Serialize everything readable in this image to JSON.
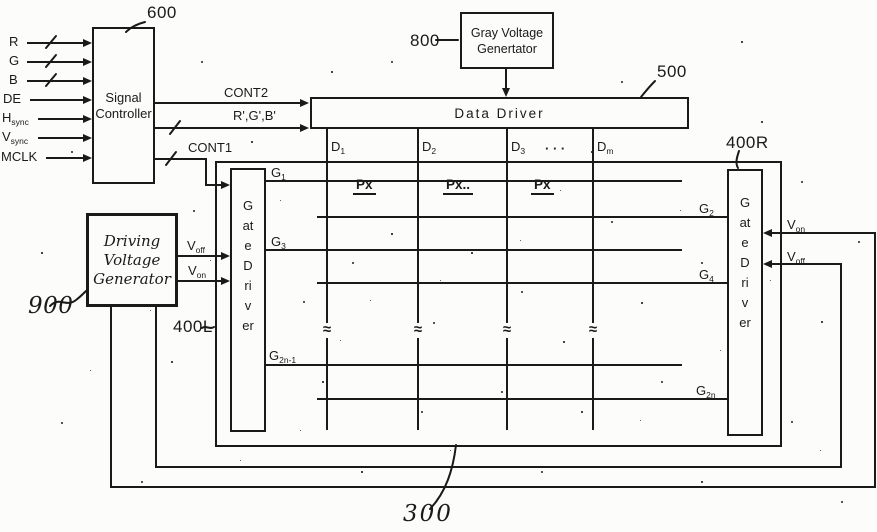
{
  "figure": {
    "refs": {
      "signal_controller": "600",
      "gray_voltage": "800",
      "data_driver": "500",
      "gate_driver_right": "400R",
      "gate_driver_left": "400L",
      "driving_voltage": "900",
      "panel": "300"
    },
    "signal_controller": {
      "line1": "Signal",
      "line2": "Controller"
    },
    "gray_voltage": {
      "line1": "Gray Voltage",
      "line2": "Genertator"
    },
    "data_driver_label": "Data Driver",
    "gate_driver_vertical": "Gate Driver",
    "driving_voltage": {
      "line1": "Driving",
      "line2": "Voltage",
      "line3": "Generator"
    },
    "inputs": [
      {
        "base": "R"
      },
      {
        "base": "G"
      },
      {
        "base": "B"
      },
      {
        "base": "DE"
      },
      {
        "base": "H",
        "sub": "sync"
      },
      {
        "base": "V",
        "sub": "sync"
      },
      {
        "base": "MCLK"
      }
    ],
    "control_signals": {
      "cont2": "CONT2",
      "rgb_prime": "R',G',B'",
      "cont1": "CONT1"
    },
    "gate_lines": [
      {
        "base": "G",
        "sub": "1"
      },
      {
        "base": "G",
        "sub": "2"
      },
      {
        "base": "G",
        "sub": "3"
      },
      {
        "base": "G",
        "sub": "4"
      },
      {
        "base": "G",
        "sub": "2n-1"
      },
      {
        "base": "G",
        "sub": "2n"
      }
    ],
    "data_lines": [
      {
        "base": "D",
        "sub": "1"
      },
      {
        "base": "D",
        "sub": "2"
      },
      {
        "base": "D",
        "sub": "3"
      },
      {
        "base": "D",
        "sub": "m"
      }
    ],
    "ellipsis": "· · ·",
    "pixels": [
      {
        "label": "Px",
        "trail": ""
      },
      {
        "label": "Px",
        "trail": ".."
      },
      {
        "label": "Px",
        "trail": ""
      }
    ],
    "voltages": {
      "left_top": {
        "base": "V",
        "sub": "off"
      },
      "left_bottom": {
        "base": "V",
        "sub": "on"
      },
      "right_top": {
        "base": "V",
        "sub": "on"
      },
      "right_bottom": {
        "base": "V",
        "sub": "off"
      }
    },
    "break_symbol": "≈"
  },
  "colors": {
    "ink": "#1a1a1a",
    "paper": "#fcfcfa"
  }
}
